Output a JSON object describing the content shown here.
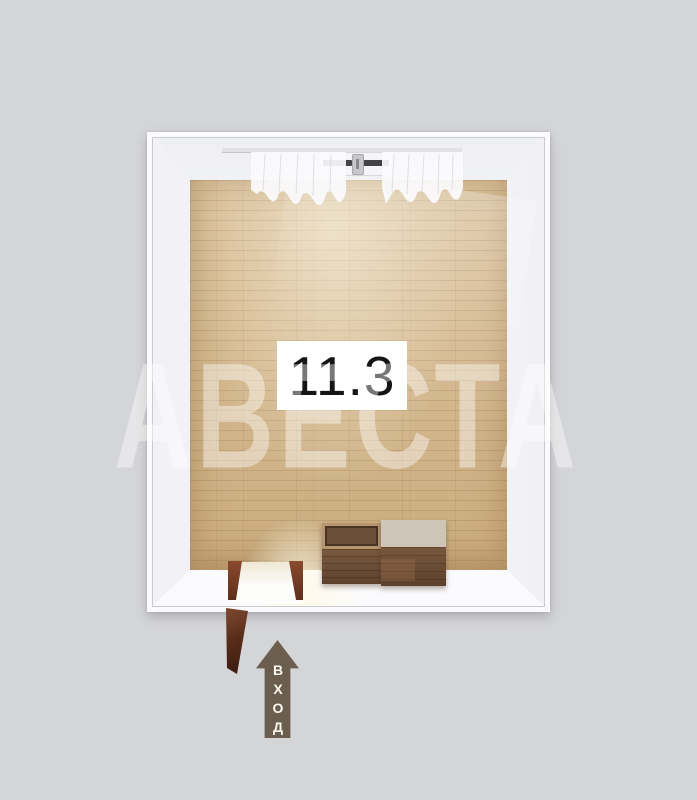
{
  "scene": {
    "background_color": "#d4d5d7",
    "watermark": {
      "text": "АВЕСТА"
    },
    "room": {
      "area_label": "11.3",
      "wall_color": "#fbfbfd",
      "floor_color": "#d3b78d"
    },
    "entrance": {
      "label": "ВХОД",
      "arrow_color": "#6b5e4f",
      "direction": "up"
    }
  }
}
